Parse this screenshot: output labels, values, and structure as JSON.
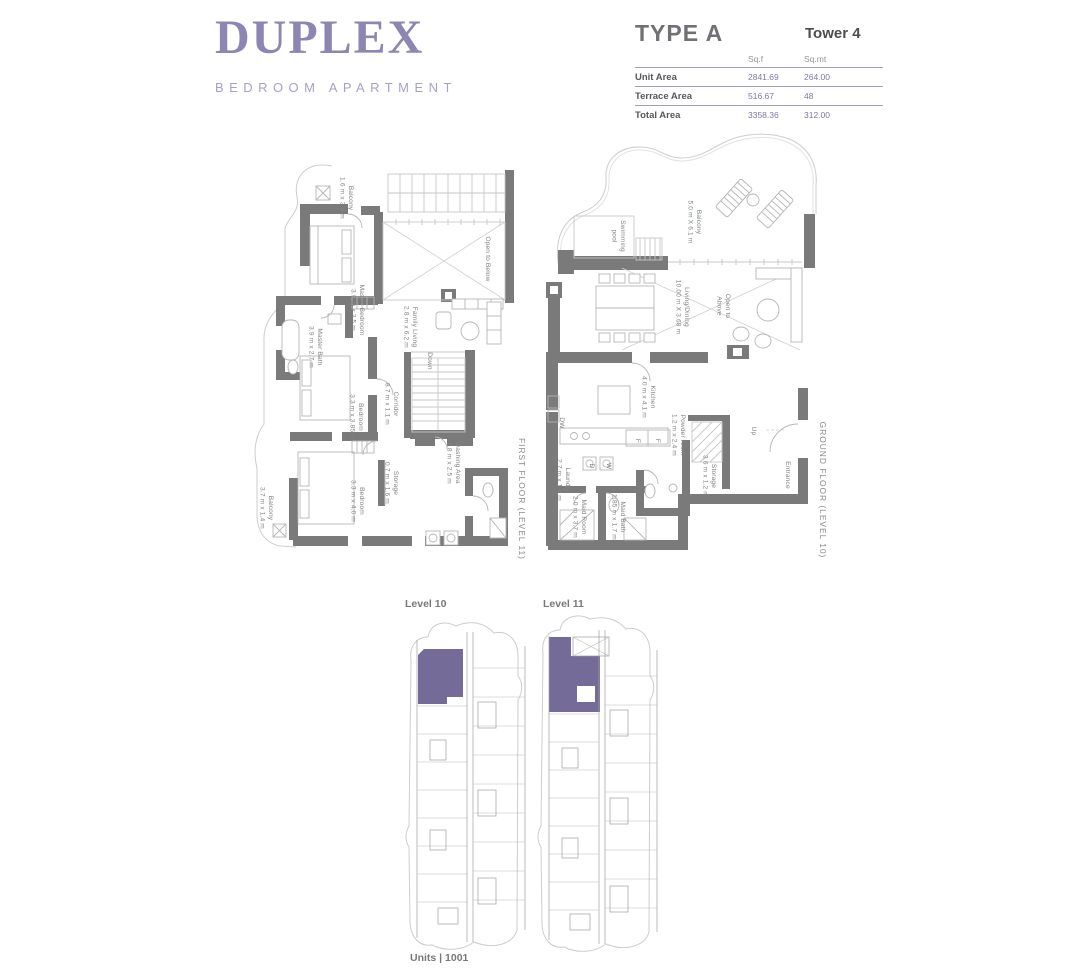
{
  "header": {
    "title": "DUPLEX",
    "subtitle": "BEDROOM APARTMENT"
  },
  "spec_table": {
    "type_label": "TYPE A",
    "tower_label": "Tower 4",
    "unit_cols": {
      "sqf": "Sq.f",
      "sqmt": "Sq.mt"
    },
    "rows": [
      {
        "label": "Unit Area",
        "sqf": "2841.69",
        "sqmt": "264.00"
      },
      {
        "label": "Terrace Area",
        "sqf": "516.67",
        "sqmt": "48"
      },
      {
        "label": "Total Area",
        "sqf": "3358.36",
        "sqmt": "312.00"
      }
    ]
  },
  "first_floor": {
    "floor_label": "FIRST FLOOR (LEVEL 11)",
    "labels": {
      "balcony_top": {
        "line1": "Balcony",
        "line2": "1.6 m x 3.4 m"
      },
      "master_bedroom": {
        "line1": "Master Bedroom",
        "line2": "3.9 m x 3.5 m"
      },
      "master_bath": {
        "line1": "Master Bath",
        "line2": "3.9 m x 2.7 m"
      },
      "open_to_below": {
        "line1": "Open to Below"
      },
      "family_living": {
        "line1": "Family Living",
        "line2": "2.8 m x 6.2 m"
      },
      "down": {
        "line1": "Down"
      },
      "corridor": {
        "line1": "Corridor",
        "line2": "8.7 m x 1.1 m"
      },
      "bedroom_1": {
        "line1": "Bedroom",
        "line2": "3.3 m x 3.85 m"
      },
      "washing_area": {
        "line1": "washing Area",
        "line2": "1.8 m x 2.5 m"
      },
      "storage": {
        "line1": "Storage",
        "line2": "0.7 m x 1.6 m"
      },
      "bedroom_2": {
        "line1": "Bedroom",
        "line2": "3.3 m x 4.0 m"
      },
      "balcony_bottom": {
        "line1": "Balcony",
        "line2": "3.7 m x 1.4 m"
      }
    }
  },
  "ground_floor": {
    "floor_label": "GROUND FLOOR (LEVEL 10)",
    "labels": {
      "swimming_pool": {
        "line1": "Swimming",
        "line2": "pool"
      },
      "balcony": {
        "line1": "Balcony",
        "line2": "5.0 m X 6.1 m"
      },
      "living_dining": {
        "line1": "Living/Dining",
        "line2": "10.00 m X 3.68 m"
      },
      "open_to_above": {
        "line1": "Open to",
        "line2": "Above"
      },
      "kitchen": {
        "line1": "Kitchen",
        "line2": "4.0 m x 4.1 m"
      },
      "powder_room": {
        "line1": "Powder room",
        "line2": "1.2 m x 2.4 m"
      },
      "storage": {
        "line1": "Storage",
        "line2": "3.6 m x 1.2 m"
      },
      "up": {
        "line1": "Up"
      },
      "entrance": {
        "line1": "Entrance"
      },
      "laundry": {
        "line1": "Laundry",
        "line2": "2.7 m x 1.6 m"
      },
      "maid_room": {
        "line1": "Maid Room",
        "line2": "2.0 m x 3.7 m"
      },
      "maid_bath": {
        "line1": "Maid Bath",
        "line2": "1.85 m x 1.7 m"
      },
      "dw": {
        "line1": "DW"
      },
      "f1": {
        "line1": "F"
      },
      "f2": {
        "line1": "F"
      },
      "w": {
        "line1": "W"
      },
      "d": {
        "line1": "D"
      }
    }
  },
  "levels": {
    "level10_label": "Level 10",
    "level11_label": "Level 11",
    "units_label": "Units | 1001"
  },
  "colors": {
    "brand_purple": "#8d86b2",
    "subtitle_purple": "#a7a1c6",
    "table_line": "#a29bc7",
    "value_purple": "#7e78a6",
    "heading_gray": "#707175",
    "dark_text": "#4c4d4f",
    "muted_gray": "#939598",
    "row_label": "#58585a",
    "wall_gray": "#7a7a7a",
    "thin_line": "#c7c7c7",
    "furniture_line": "#b5b5b5",
    "label_gray": "#7f8285",
    "unit_highlight": "#756b99",
    "plate_line": "#9f9f9f"
  }
}
